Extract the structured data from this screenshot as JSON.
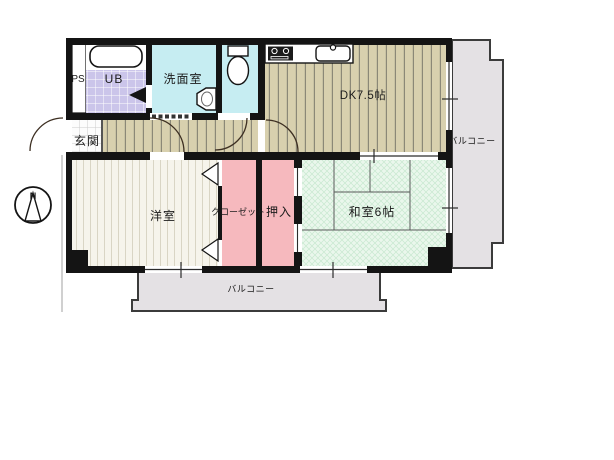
{
  "plan": {
    "type": "apartment-floorplan",
    "rooms": {
      "ps_label": "PS",
      "ub_label": "UB",
      "washroom_label": "洗面室",
      "entrance_label": "玄関",
      "dk_label": "DK7.5帖",
      "western_room_label": "洋室",
      "closet_label": "クローゼット",
      "oshiire_label": "押入",
      "japanese_room_label": "和室6帖",
      "balcony_right_label": "バルコニー",
      "balcony_bottom_label": "バルコニー"
    },
    "compass": {
      "north_label": "N"
    },
    "colors": {
      "wall": "#141414",
      "wet_area_cyan": "#c6edf2",
      "unit_bath_purple": "#cbc5ea",
      "wood_floor_tan": "#d8d0ae",
      "western_room_cream": "#f6f4eb",
      "closet_pink": "#f6b9be",
      "tatami_green": "#eaf7ec",
      "entrance_tile": "#fcfcfc",
      "balcony_gray": "#e4e1e4",
      "background": "#ffffff"
    }
  }
}
